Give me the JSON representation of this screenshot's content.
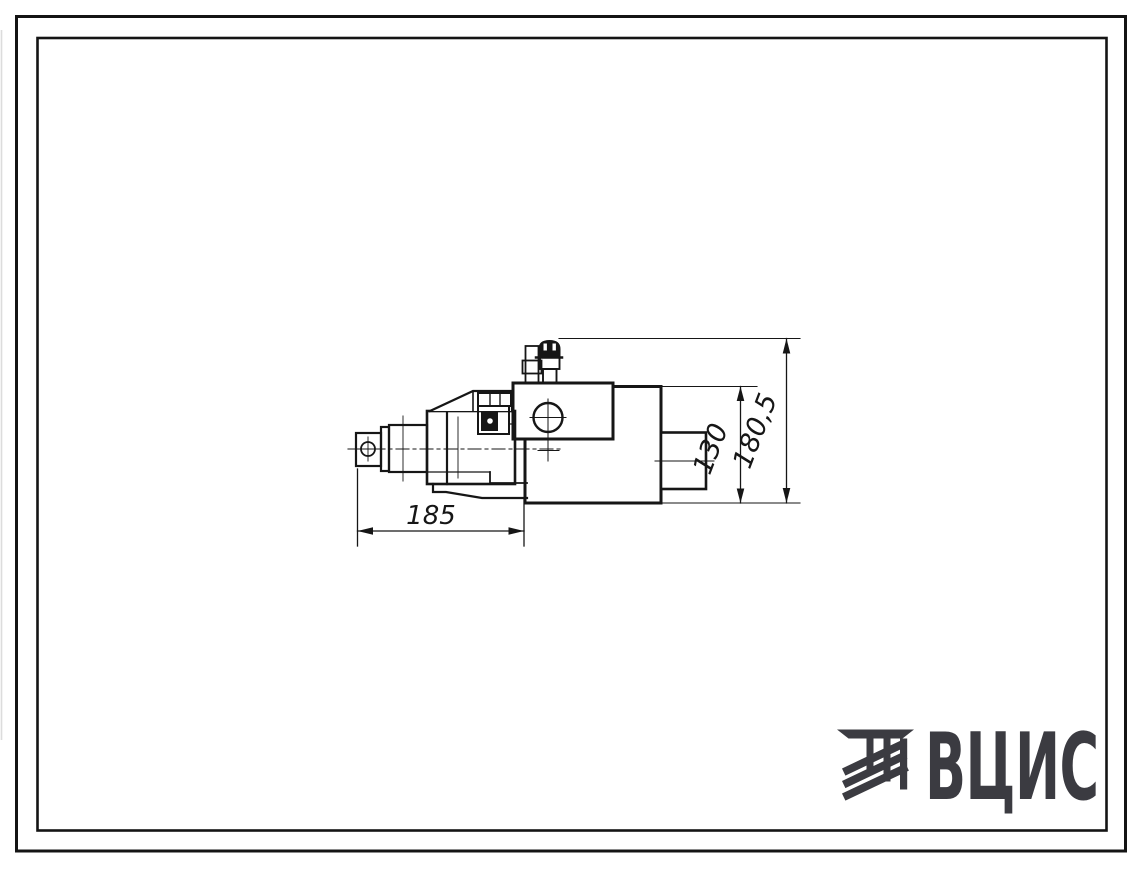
{
  "page": {
    "kind": "scanned technical drawing sheet",
    "background": "#ffffff",
    "line_color": "#161616"
  },
  "drawing": {
    "description": "side view of an electro-hydraulic valve / electromagnet assembly",
    "dimensions": [
      {
        "label": "185",
        "orientation": "horizontal",
        "measures": "length of left electromagnet assembly"
      },
      {
        "label": "130",
        "orientation": "vertical",
        "measures": "height of main valve body"
      },
      {
        "label": "180,5",
        "orientation": "vertical",
        "measures": "overall height including top fitting"
      }
    ]
  },
  "logo": {
    "text": "ВЦИС",
    "color": "#3b3b41",
    "mark": "diagonal-hatched bars emblem"
  }
}
